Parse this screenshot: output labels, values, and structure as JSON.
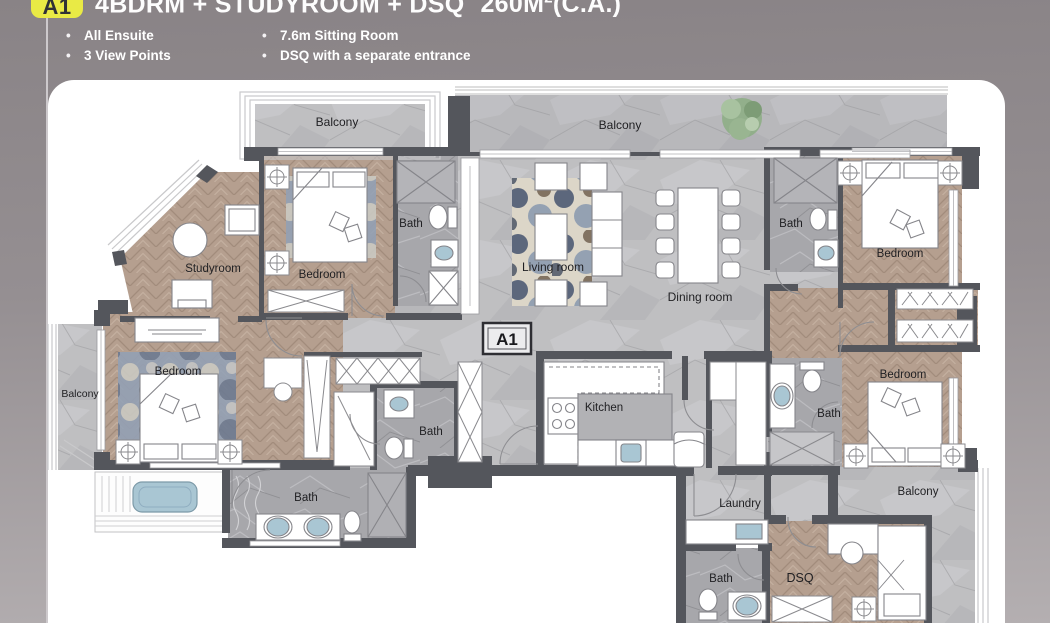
{
  "header": {
    "badge": "A1",
    "title_main": "4BDRM + STUDYROOM + DSQ",
    "area_value": "260M",
    "area_sup": "2",
    "area_suffix": "(C.A.)",
    "bullets_col1": [
      "All Ensuite",
      "3 View Points"
    ],
    "bullets_col2": [
      "7.6m Sitting Room",
      "DSQ with a separate entrance"
    ],
    "bullet_char": "•"
  },
  "floorplan": {
    "unit_label": "A1",
    "labels": [
      {
        "text": "Balcony",
        "x": 337,
        "y": 126,
        "size": 12
      },
      {
        "text": "Balcony",
        "x": 620,
        "y": 129,
        "size": 12
      },
      {
        "text": "Bath",
        "x": 411,
        "y": 227,
        "size": 11.5
      },
      {
        "text": "Bath",
        "x": 791,
        "y": 227,
        "size": 11.5
      },
      {
        "text": "Bedroom",
        "x": 322,
        "y": 278,
        "size": 11.5
      },
      {
        "text": "Bedroom",
        "x": 900,
        "y": 257,
        "size": 11.5
      },
      {
        "text": "Studyroom",
        "x": 213,
        "y": 272,
        "size": 11.5
      },
      {
        "text": "Living room",
        "x": 553,
        "y": 271,
        "size": 12
      },
      {
        "text": "Dining room",
        "x": 700,
        "y": 301,
        "size": 12
      },
      {
        "text": "Balcony",
        "x": 80,
        "y": 397,
        "size": 10.5
      },
      {
        "text": "Bedroom",
        "x": 178,
        "y": 375,
        "size": 11.5
      },
      {
        "text": "Bath",
        "x": 431,
        "y": 435,
        "size": 11.5
      },
      {
        "text": "Kitchen",
        "x": 604,
        "y": 411,
        "size": 11.5
      },
      {
        "text": "Bath",
        "x": 829,
        "y": 417,
        "size": 11.5
      },
      {
        "text": "Bedroom",
        "x": 903,
        "y": 378,
        "size": 11.5
      },
      {
        "text": "Bath",
        "x": 306,
        "y": 501,
        "size": 11.5
      },
      {
        "text": "Laundry",
        "x": 740,
        "y": 507,
        "size": 11.5
      },
      {
        "text": "Balcony",
        "x": 918,
        "y": 495,
        "size": 11.5
      },
      {
        "text": "Bath",
        "x": 721,
        "y": 582,
        "size": 11.5
      },
      {
        "text": "DSQ",
        "x": 800,
        "y": 582,
        "size": 12.5
      }
    ]
  },
  "colors": {
    "accent_yellow": "#e9ea45",
    "wall": "#54565c",
    "wood": "#b59f8f",
    "marble": "#bfbfc1",
    "water_blue": "#a9c6d3",
    "plant_green": "#8fae88",
    "background_top": "#898386",
    "background_bottom": "#b4afb1"
  }
}
